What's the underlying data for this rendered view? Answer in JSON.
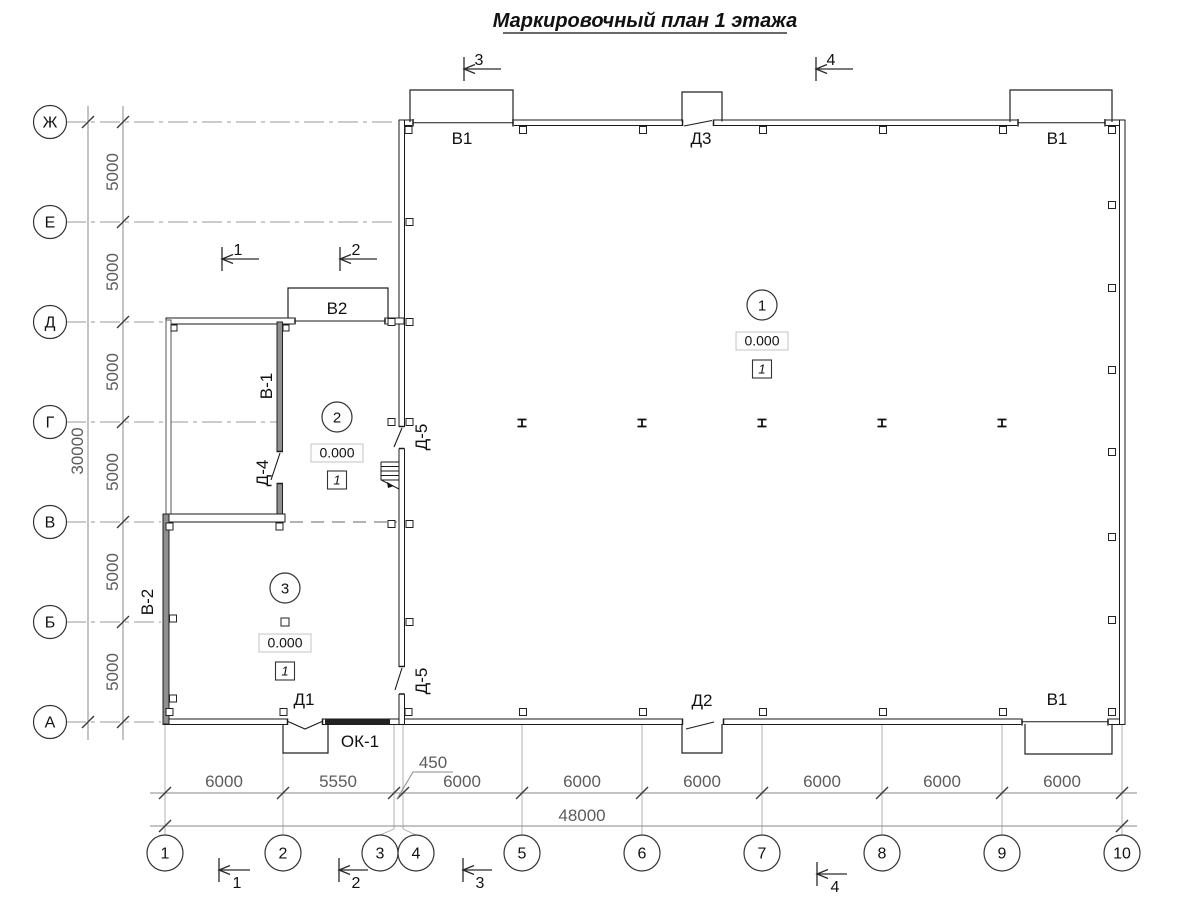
{
  "title": "Маркировочный план 1 этажа",
  "axes": {
    "rows": [
      "Ж",
      "Е",
      "Д",
      "Г",
      "В",
      "Б",
      "А"
    ],
    "cols": [
      "1",
      "2",
      "3",
      "4",
      "5",
      "6",
      "7",
      "8",
      "9",
      "10"
    ]
  },
  "dims": {
    "v_spacing": [
      "5000",
      "5000",
      "5000",
      "5000",
      "5000",
      "5000"
    ],
    "v_total": "30000",
    "h_labels": [
      "6000",
      "5550",
      "450",
      "6000",
      "6000",
      "6000",
      "6000",
      "6000",
      "6000"
    ],
    "h_total": "48000"
  },
  "sections": {
    "top": [
      "3",
      "4"
    ],
    "middle": [
      "1",
      "2"
    ],
    "bottom": [
      "1",
      "2",
      "3",
      "4"
    ]
  },
  "openings": {
    "v1_top_left": "В1",
    "d3": "Д3",
    "v1_top_right": "В1",
    "v2": "В2",
    "v1_partition": "В-1",
    "d4": "Д-4",
    "d5_upper": "Д-5",
    "v2_exterior": "В-2",
    "d1": "Д1",
    "ok1": "ОК-1",
    "d5_lower": "Д-5",
    "d2": "Д2",
    "v1_bottom_right": "В1"
  },
  "rooms": [
    {
      "number": "1",
      "elevation": "0.000",
      "floor_type": "1"
    },
    {
      "number": "2",
      "elevation": "0.000",
      "floor_type": "1"
    },
    {
      "number": "3",
      "elevation": "0.000",
      "floor_type": "1"
    }
  ],
  "colors": {
    "wall": "#1a1a1a",
    "grid": "#999999",
    "dim_text": "#5c5c5c",
    "text": "#111111"
  }
}
